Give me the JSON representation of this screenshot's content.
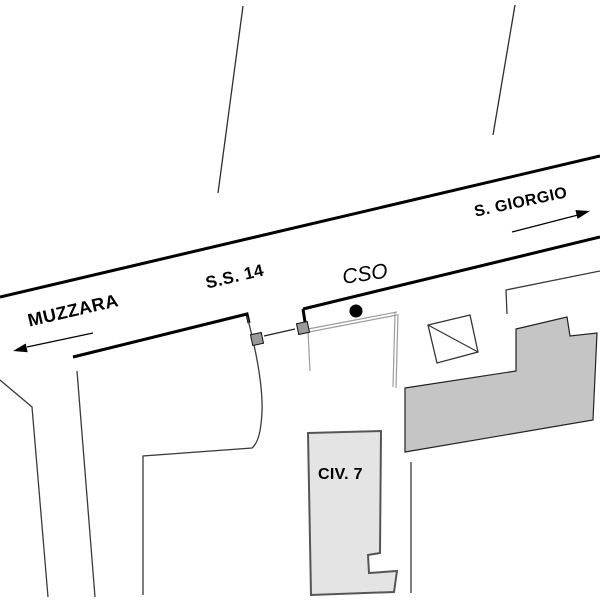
{
  "map": {
    "background_color": "#ffffff",
    "road": {
      "name_label": "S.S. 14",
      "left_direction_label": "MUZZARA",
      "right_direction_label": "S. GIORGIO"
    },
    "marker": {
      "label": "CSO",
      "dot_color": "#000000"
    },
    "buildings": {
      "civ7_label": "CIV. 7",
      "large_building_color": "#c5c5c5",
      "civ7_building_color": "#e4e4e4"
    },
    "gate_post_color": "#9a9a9a",
    "line_color": "#000000",
    "thin_line_color": "#3a3a3a",
    "sidewalk_line_color": "#9d9d9d"
  }
}
